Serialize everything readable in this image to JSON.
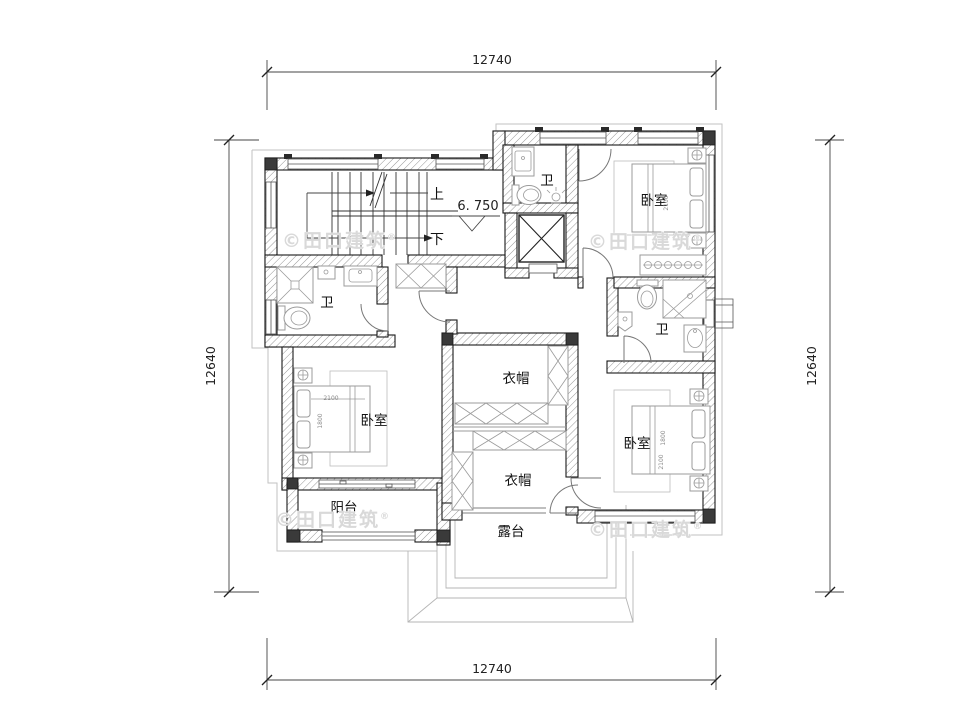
{
  "colors": {
    "wall_line": "#1a1a1a",
    "furniture": "#9b9b9b",
    "eave": "#c2c2c2",
    "dimension": "#444444",
    "watermark": "#d9d9d9",
    "background": "#ffffff"
  },
  "dimensions": {
    "top": "12740",
    "bottom": "12740",
    "left": "12640",
    "right": "12640"
  },
  "stair": {
    "up_label": "上",
    "down_label": "下",
    "elevation": "6. 750"
  },
  "rooms": [
    {
      "id": "bath-top",
      "label": "卫"
    },
    {
      "id": "bedroom-top-right",
      "label": "卧室"
    },
    {
      "id": "bath-left",
      "label": "卫"
    },
    {
      "id": "bath-right",
      "label": "卫"
    },
    {
      "id": "cloak-upper",
      "label": "衣帽"
    },
    {
      "id": "cloak-lower",
      "label": "衣帽"
    },
    {
      "id": "bedroom-left",
      "label": "卧室"
    },
    {
      "id": "bedroom-right",
      "label": "卧室"
    },
    {
      "id": "balcony",
      "label": "阳台"
    },
    {
      "id": "terrace",
      "label": "露台"
    }
  ],
  "bed_dimensions": {
    "width": "2100",
    "depth": "1800"
  },
  "watermark": {
    "text": "©田口建筑",
    "reg": "®"
  }
}
